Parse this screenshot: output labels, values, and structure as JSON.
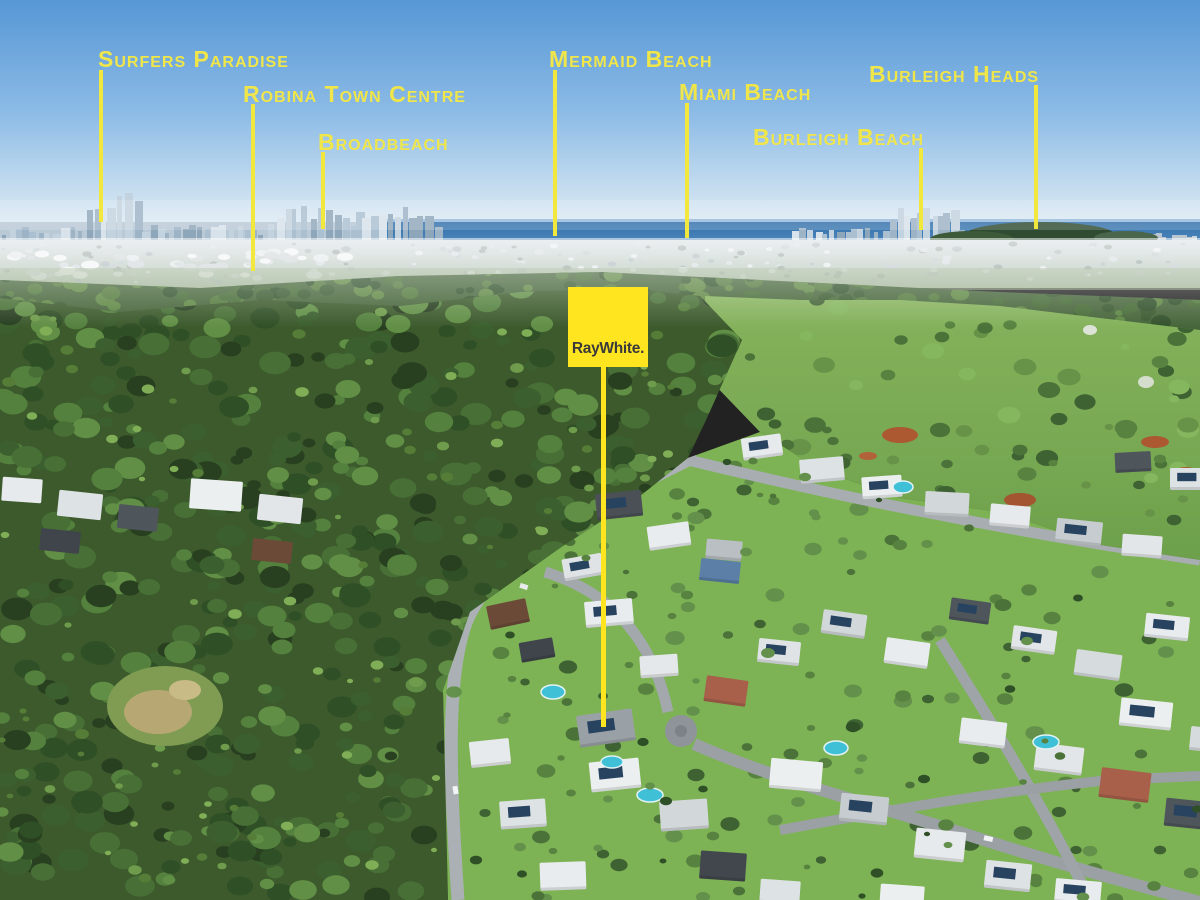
{
  "palette": {
    "label_yellow": "#F0E64A",
    "line_yellow": "#F2E73C",
    "logo_yellow": "#FFE51F",
    "logo_ink": "#3A393B"
  },
  "logo": {
    "brand": "RayWhite."
  },
  "annotations": {
    "labels": [
      {
        "id": "surfers-paradise",
        "text": "Surfers Paradise"
      },
      {
        "id": "robina-town-centre",
        "text": "Robina Town Centre"
      },
      {
        "id": "broadbeach",
        "text": "Broadbeach"
      },
      {
        "id": "mermaid-beach",
        "text": "Mermaid Beach"
      },
      {
        "id": "miami-beach",
        "text": "Miami Beach"
      },
      {
        "id": "burleigh-beach",
        "text": "Burleigh Beach"
      },
      {
        "id": "burleigh-heads",
        "text": "Burleigh Heads"
      }
    ]
  }
}
